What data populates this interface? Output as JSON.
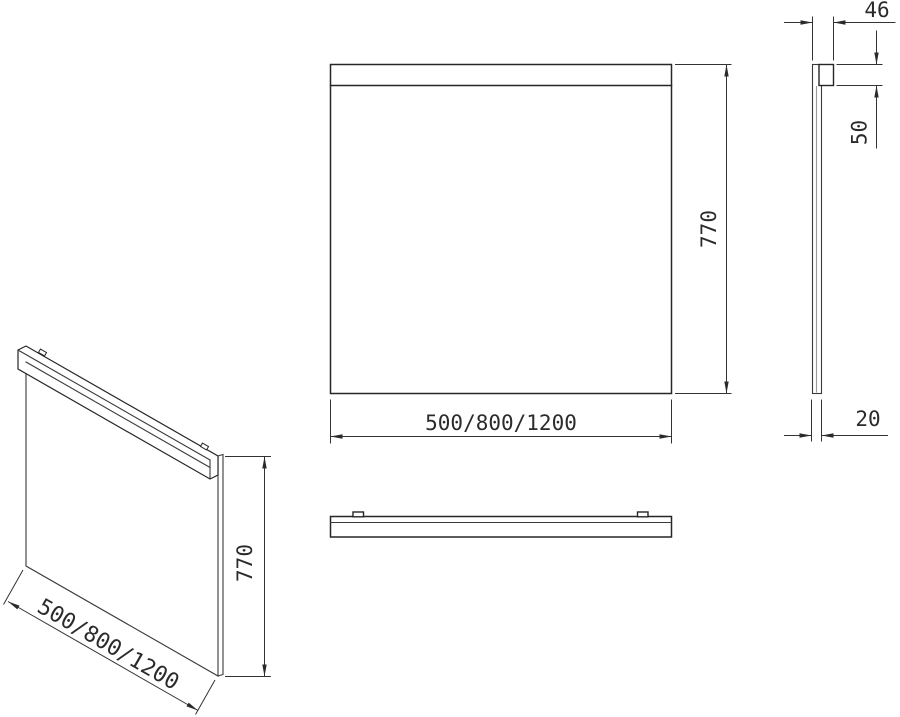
{
  "drawing": {
    "background_color": "#ffffff",
    "line_color": "#262626",
    "shade_color": "#9a9a9a",
    "views": {
      "front": {
        "height_label": "770",
        "width_label": "500/800/1200"
      },
      "side": {
        "depth_label": "46",
        "rail_height_label": "50",
        "thickness_label": "20"
      },
      "isometric": {
        "height_label": "770",
        "width_label": "500/800/1200"
      }
    }
  }
}
